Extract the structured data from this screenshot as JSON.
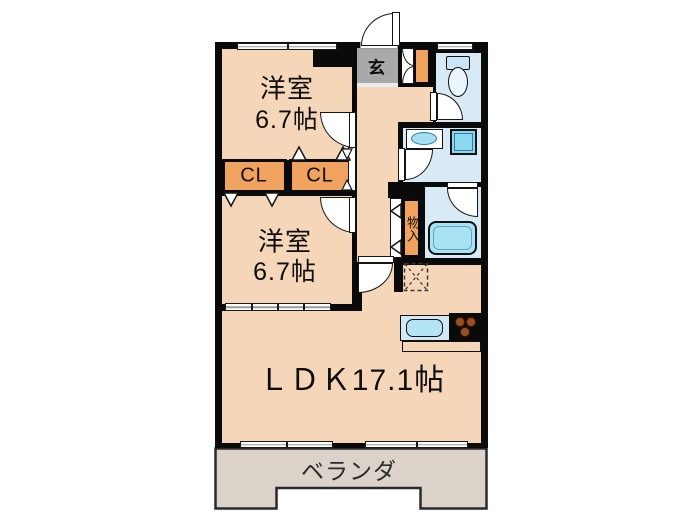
{
  "labels": {
    "bedroom1_name": "洋室",
    "bedroom1_size": "6.7帖",
    "bedroom2_name": "洋室",
    "bedroom2_size": "6.7帖",
    "ldk": "ＬＤＫ17.1帖",
    "veranda": "ベランダ",
    "entrance": "玄",
    "closet1": "CL",
    "closet2": "CL",
    "storage": "物入"
  },
  "colors": {
    "floor_peach": "#F6D6B8",
    "wet_room_blue": "#D9EAF7",
    "storage_orange": "#F0A35F",
    "genkan_gray": "#A9A9A9",
    "veranda_gray": "#DBD3CA",
    "fixture_cyan": "#8BD8EE",
    "counter_blue": "#CFE9F7",
    "wall_black": "#0A0A0A",
    "burner_brown": "#9C4F1D"
  },
  "icons": {
    "toilet-icon": "tank rectangle + oval bowl",
    "washbasin-icon": "rectangle with oval basin",
    "washing-machine-icon": "square pan",
    "bathtub-icon": "rounded rectangle tub",
    "kitchen-sink-icon": "rounded rectangle sink in counter",
    "stove-icon": "black square with 3 brown burners",
    "refrigerator-space-icon": "dashed square with X",
    "door-swing-icon": "quarter circle arc",
    "window-icon": "white bar in wall",
    "bifold-door-icon": "small triangle"
  }
}
